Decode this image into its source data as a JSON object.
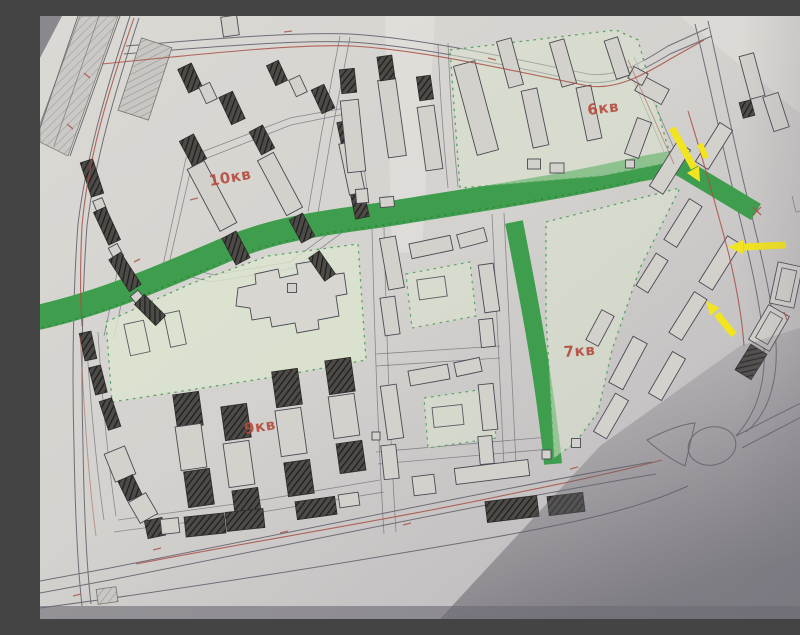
{
  "quarters": [
    {
      "id": "10kv",
      "label": "10кв"
    },
    {
      "id": "9kv",
      "label": "9кв"
    },
    {
      "id": "6kv",
      "label": "6кв"
    },
    {
      "id": "7kv",
      "label": "7кв"
    }
  ],
  "annotations": {
    "arrows": [
      {
        "name": "arrow-1",
        "direction": "down-right, at end of green street"
      },
      {
        "name": "arrow-2",
        "direction": "left, at building row by road"
      },
      {
        "name": "arrow-3",
        "direction": "up-left, at lower building row"
      }
    ]
  },
  "colors": {
    "paper": "#d7d5d0",
    "roadline": "#6f6e78",
    "red-line": "#a84f44",
    "label-red": "#b44b3c",
    "street-green": "#3f9e4e",
    "park-green": "#dce5cf",
    "park-border": "#5aa463",
    "arrow-yellow": "#f2e41f",
    "building-fill": "#d3d1cc",
    "building-stroke": "#4a4952"
  }
}
